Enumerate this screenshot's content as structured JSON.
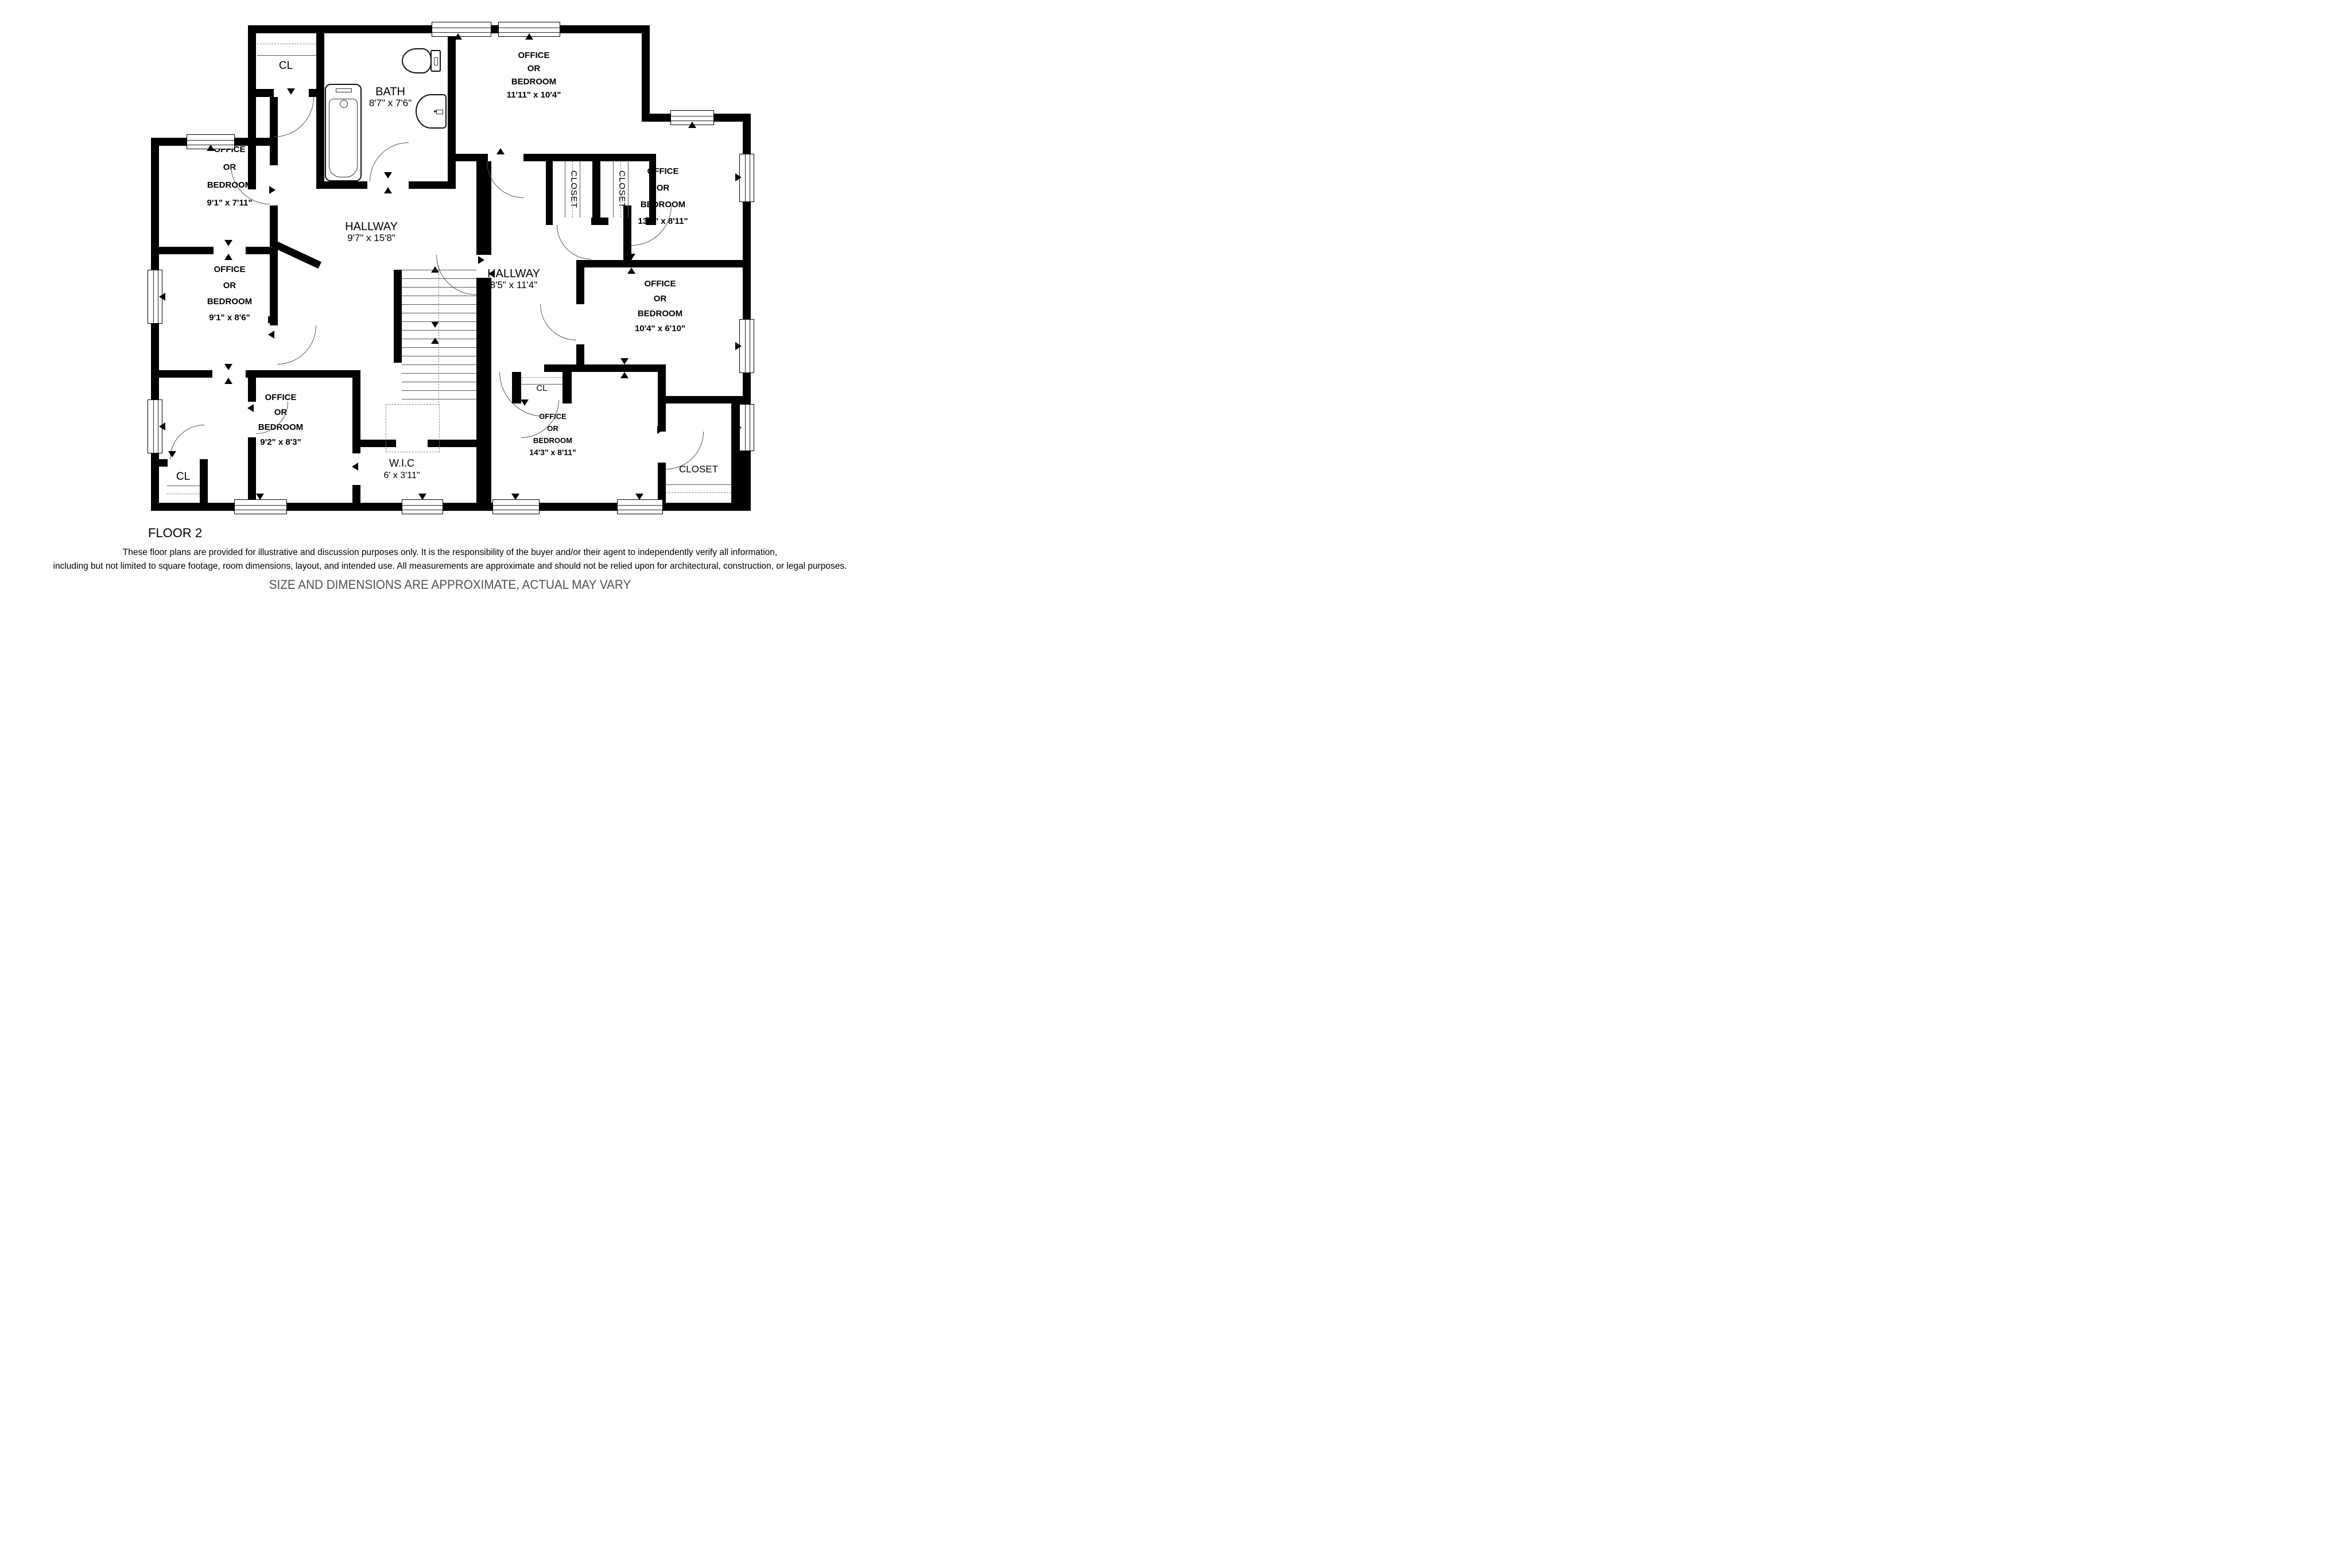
{
  "plan": {
    "floor_label": "FLOOR 2",
    "labels": {
      "cl": "CL",
      "closet": "CLOSET"
    },
    "rooms": {
      "r1": {
        "l1": "OFFICE",
        "l2": "OR",
        "l3": "BEDROOM",
        "dims": "9'1\" x 7'11\""
      },
      "r2": {
        "l1": "OFFICE",
        "l2": "OR",
        "l3": "BEDROOM",
        "dims": "9'1\" x 8'6\""
      },
      "r3": {
        "l1": "OFFICE",
        "l2": "OR",
        "l3": "BEDROOM",
        "dims": "9'2\" x 8'3\""
      },
      "r4": {
        "l1": "OFFICE",
        "l2": "OR",
        "l3": "BEDROOM",
        "dims": "11'11\" x 10'4\""
      },
      "r5": {
        "l1": "OFFICE",
        "l2": "OR",
        "l3": "BEDROOM",
        "dims": "13'4\" x 8'11\""
      },
      "r6": {
        "l1": "OFFICE",
        "l2": "OR",
        "l3": "BEDROOM",
        "dims": "10'4\" x 6'10\""
      },
      "r7": {
        "l1": "OFFICE",
        "l2": "OR",
        "l3": "BEDROOM",
        "dims": "14'3\" x 8'11\""
      },
      "bath": {
        "name": "BATH",
        "dims": "8'7\" x 7'6\""
      },
      "hallway1": {
        "name": "HALLWAY",
        "dims": "9'7\" x 15'8\""
      },
      "hallway2": {
        "name": "HALLWAY",
        "dims": "8'5\" x 11'4\""
      },
      "wic": {
        "name": "W.I.C",
        "dims": "6' x 3'11\""
      }
    },
    "disclaimer": {
      "line1": "These floor plans are provided for illustrative and discussion purposes only. It is the responsibility of the buyer and/or their agent to independently verify all information,",
      "line2": "including but not limited to square footage, room dimensions, layout, and intended use. All measurements are approximate and should not be relied upon for architectural, construction, or legal purposes."
    },
    "footer_note": "SIZE AND DIMENSIONS ARE APPROXIMATE, ACTUAL MAY VARY"
  }
}
